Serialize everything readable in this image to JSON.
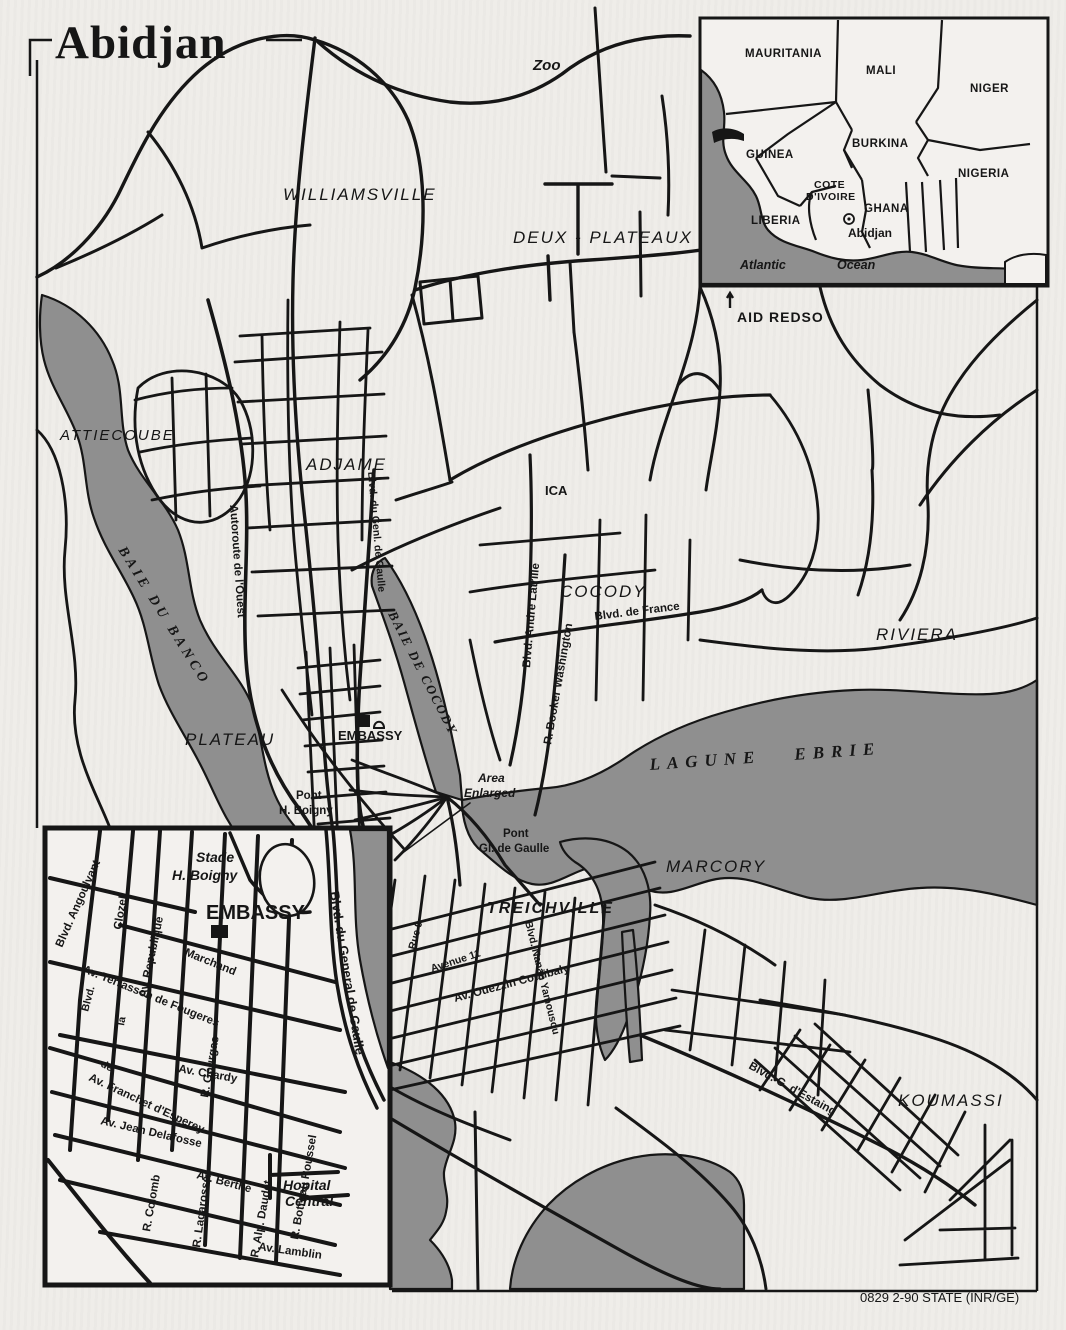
{
  "title": "Abidjan",
  "credit": "0829 2-90 STATE (INR/GE)",
  "colors": {
    "paper": "#efede9",
    "water": "#8f8f8f",
    "ink": "#161616"
  },
  "main_map": {
    "districts": {
      "williamsville": "WILLIAMSVILLE",
      "deux_plateaux": "DEUX - PLATEAUX",
      "attiecoube": "ATTIECOUBE",
      "adjame": "ADJAME",
      "cocody": "COCODY",
      "riviera": "RIVIERA",
      "plateau": "PLATEAU",
      "marcory": "MARCORY",
      "treichville": "TREICHVILLE",
      "koumassi": "KOUMASSI"
    },
    "water": {
      "baie_du_banco": "BAIE DU BANCO",
      "baie_de_cocody": "BAIE DE COCODY",
      "lagune_ebrie": "LAGUNE  EBRIE"
    },
    "pois": {
      "zoo": "Zoo",
      "aid_redso": "AID REDSO",
      "ica": "ICA",
      "embassy": "EMBASSY",
      "pont_boigny": {
        "l1": "Pont",
        "l2": "H. Boigny"
      },
      "pont_gaulle": {
        "l1": "Pont",
        "l2": "Gl. de Gaulle"
      },
      "area_enlarged": {
        "l1": "Area",
        "l2": "Enlarged"
      }
    },
    "streets": {
      "autoroute": "Autoroute de l'Ouest",
      "gaulle": "Blvd. du Genl. de Gaulle",
      "latrille": "Blvd. Andre Latrille",
      "france": "Blvd. de France",
      "booker": "R. Booker Washington",
      "rue9": "Rue 9",
      "avenue11": "Avenue 11",
      "nanan": "Blvd. Nanan Yamousou",
      "ouezzin": "Av. Ouezzin Coulibaly",
      "estaing": "Blvd. G. d'Estaing"
    }
  },
  "region_inset": {
    "countries": {
      "mauritania": "MAURITANIA",
      "mali": "MALI",
      "niger": "NIGER",
      "guinea": "GUINEA",
      "burkina": "BURKINA",
      "nigeria": "NIGERIA",
      "cote_l1": "COTE",
      "cote_l2": "D'IVOIRE",
      "ghana": "GHANA",
      "liberia": "LIBERIA"
    },
    "city": "Abidjan",
    "ocean_l1": "Atlantic",
    "ocean_l2": "Ocean"
  },
  "plateau_inset": {
    "pois": {
      "stade_l1": "Stade",
      "stade_l2": "H. Boigny",
      "embassy": "EMBASSY",
      "hopital_l1": "Hopital",
      "hopital_l2": "Central"
    },
    "streets": {
      "angoulvant": "Blvd. Angoulvant",
      "clozel": "Clozel",
      "republique": "Av. Republique",
      "marchand": "Marchand",
      "terrasson": "Av. Terrasson de Fougeres",
      "gourgas": "R. Gourgas",
      "chardy": "Av. Chardy",
      "franchet": "Av. Franchet d'Esperey",
      "delafosse": "Av. Jean Delafosse",
      "colomb": "R. Colomb",
      "berthe": "Av. Berthe",
      "lagarosse": "R. Lagarosse",
      "daudet": "R. Alp. Daudet",
      "botreau": "R. Botreau Roussel",
      "lamblin": "Av. Lamblin",
      "gaulle": "Blvd. du General de Gaulle"
    },
    "fragments": {
      "f1": "Blvd.",
      "f2": "de",
      "f3": "la"
    }
  }
}
